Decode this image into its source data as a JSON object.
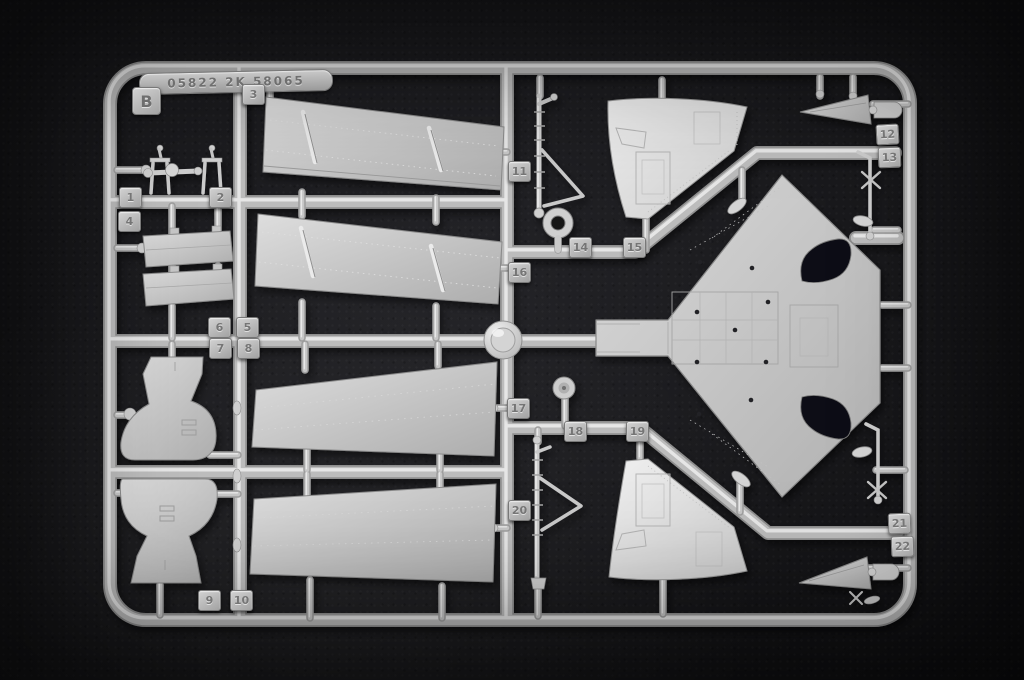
{
  "sprue": {
    "letter": "B",
    "mold_code": "05822 2K 58065",
    "part_tags": [
      "1",
      "2",
      "3",
      "4",
      "5",
      "6",
      "7",
      "8",
      "9",
      "10",
      "11",
      "12",
      "13",
      "14",
      "15",
      "16",
      "17",
      "18",
      "19",
      "20",
      "21",
      "22"
    ],
    "colors": {
      "plastic_light": "#e9e9e9",
      "plastic_mid": "#c2c2c2",
      "plastic_dark": "#8f8f8f",
      "background": "#131316"
    }
  }
}
